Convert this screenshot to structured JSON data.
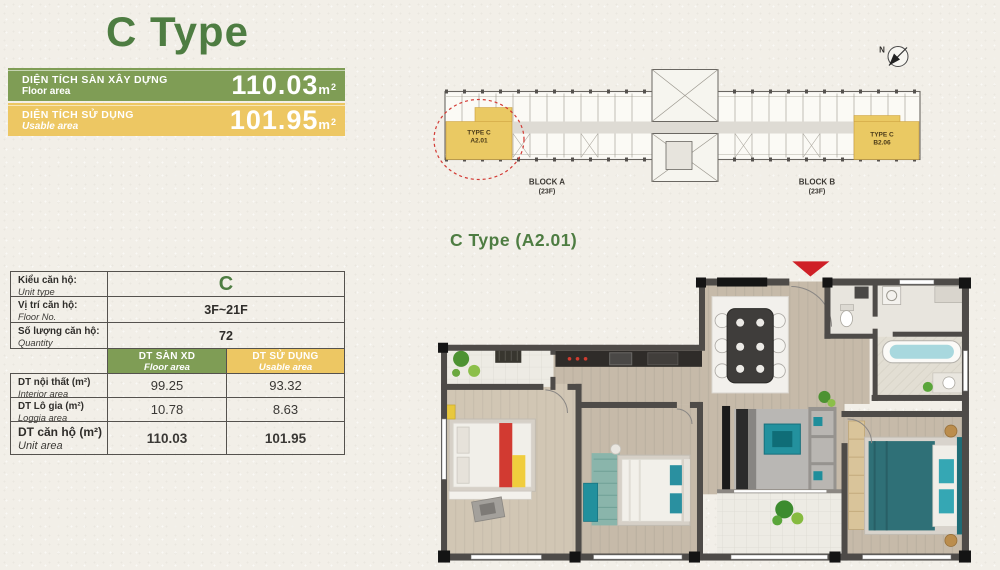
{
  "page_title": "C Type",
  "banners": [
    {
      "label_vn": "DIỆN TÍCH SÀN XÂY DỰNG",
      "label_en": "Floor area",
      "value": "110.03",
      "unit": "m",
      "unit_sup": "2",
      "color": "#7f9d55"
    },
    {
      "label_vn": "DIỆN TÍCH SỬ DỤNG",
      "label_en": "Usable area",
      "value": "101.95",
      "unit": "m",
      "unit_sup": "2",
      "color": "#edc763"
    }
  ],
  "table": {
    "info_rows": [
      {
        "label_vn": "Kiểu căn hộ:",
        "label_en": "Unit type",
        "value": "C"
      },
      {
        "label_vn": "Vị trí căn hộ:",
        "label_en": "Floor No.",
        "value": "3F~21F"
      },
      {
        "label_vn": "Số lượng căn hộ:",
        "label_en": "Quantity",
        "value": "72"
      }
    ],
    "col_headers": [
      {
        "vn": "DT SÀN XD",
        "en": "Floor area",
        "color": "#7f9d55"
      },
      {
        "vn": "DT SỬ DỤNG",
        "en": "Usable area",
        "color": "#edc763"
      }
    ],
    "area_rows": [
      {
        "label_vn": "DT nội thất (m²)",
        "label_en": "Interior area",
        "floor_area": "99.25",
        "usable_area": "93.32"
      },
      {
        "label_vn": "DT Lô gia (m²)",
        "label_en": "Loggia area",
        "floor_area": "10.78",
        "usable_area": "8.63"
      },
      {
        "label_vn": "DT căn hộ (m²)",
        "label_en": "Unit area",
        "floor_area": "110.03",
        "usable_area": "101.95"
      }
    ]
  },
  "site_plan": {
    "compass": "N",
    "unit_left_type": "TYPE C",
    "unit_left_code": "A2.01",
    "unit_right_type": "TYPE C",
    "unit_right_code": "B2.06",
    "block_a": "BLOCK A",
    "block_a_floors": "(23F)",
    "block_b": "BLOCK B",
    "block_b_floors": "(23F)",
    "highlight_color": "#eac963"
  },
  "floor_plan": {
    "title": "C Type (A2.01)",
    "entry_marker_color": "#cf2027"
  },
  "colors": {
    "title_green": "#4e7d42",
    "banner_green": "#7f9d55",
    "banner_yellow": "#edc763",
    "accent_red": "#cf2027",
    "background": "#f2efe8"
  }
}
